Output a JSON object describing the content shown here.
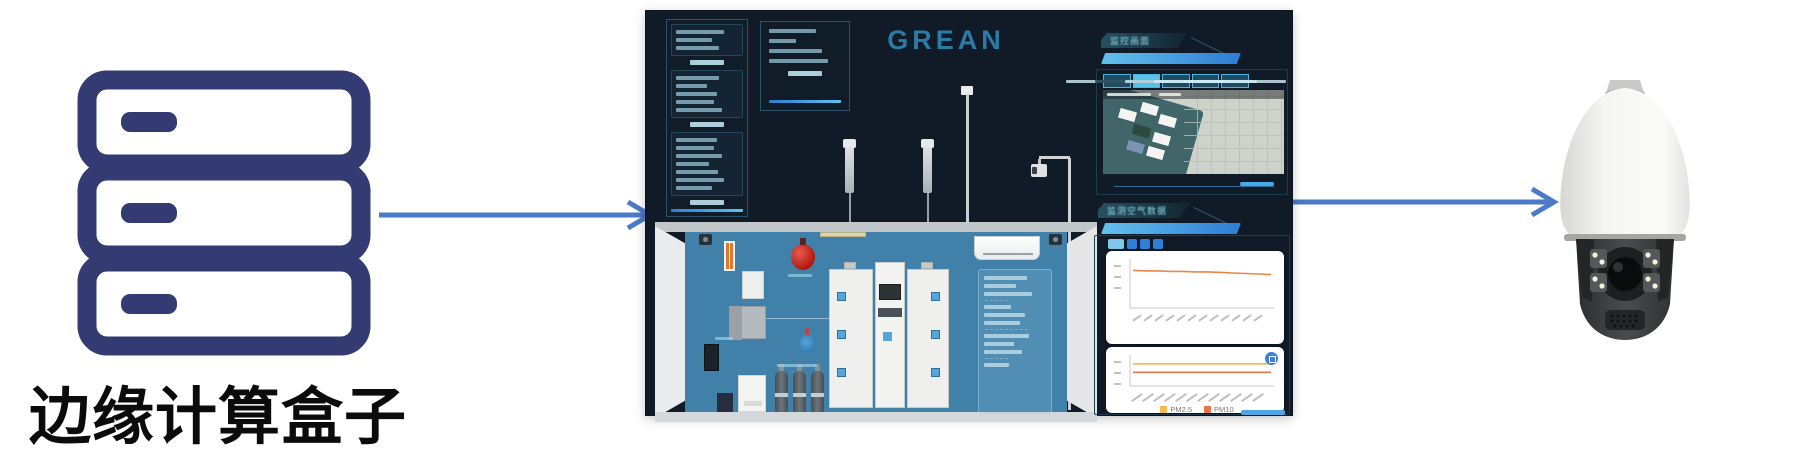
{
  "diagram": {
    "arrow_color": "#4a7ac8",
    "left_node": {
      "label": "边缘计算盒子",
      "icon": "server-stack-icon",
      "icon_color": "#333b72",
      "label_color": "#0b0b0b"
    },
    "center_node": {
      "description": "monitoring-dashboard-screenshot"
    },
    "right_node": {
      "icon": "ptz-dome-camera"
    }
  },
  "dashboard": {
    "logo": "GREAN",
    "logo_color": "#2b7ba6",
    "bg_color": "#111a27",
    "room_wall_color": "#4181a9",
    "left_panel": {
      "sections": [
        {
          "rows": 3
        },
        {
          "rows": 5
        },
        {
          "rows": 7
        }
      ]
    },
    "info_box": {
      "rows": 4
    },
    "video_panel": {
      "title": "监控画面",
      "tabs": [
        "",
        "",
        "",
        "",
        ""
      ],
      "active_tab": 1
    },
    "air_panel": {
      "title": "监测空气数据"
    },
    "room": {
      "overlay_rows": 10,
      "equipment": [
        "fire-suppression-ball",
        "monitoring-cabinet-left",
        "monitoring-cabinet-center",
        "monitoring-cabinet-right",
        "air-conditioner",
        "gas-cylinders",
        "sampling-probes",
        "sampling-pole",
        "ceiling-camera",
        "wall-cameras",
        "data-overlay-panel",
        "ups-cabinet",
        "access-device"
      ]
    }
  },
  "chart_data": [
    {
      "type": "line",
      "title": "",
      "x": [
        "",
        "",
        "",
        "",
        "",
        "",
        "",
        "",
        "",
        "",
        "",
        ""
      ],
      "series": [
        {
          "name": "颗粒物",
          "color": "#e8874a",
          "values": [
            66,
            65,
            65,
            64,
            64,
            63,
            63,
            62,
            61,
            60,
            59,
            58
          ]
        }
      ],
      "ylim": [
        0,
        80
      ],
      "xlabel": "",
      "ylabel": "",
      "grid": false,
      "legend_position": "none"
    },
    {
      "type": "line",
      "title": "",
      "x": [
        "",
        "",
        "",
        "",
        "",
        "",
        "",
        "",
        "",
        "",
        "",
        ""
      ],
      "series": [
        {
          "name": "PM2.5",
          "color": "#f3bc4a",
          "values": [
            72,
            72,
            72,
            72,
            72,
            72,
            72,
            72,
            72,
            72,
            72,
            72
          ]
        },
        {
          "name": "PM10",
          "color": "#e9744a",
          "values": [
            40,
            40,
            40,
            40,
            40,
            40,
            40,
            40,
            40,
            40,
            40,
            40
          ]
        }
      ],
      "ylim": [
        0,
        90
      ],
      "xlabel": "",
      "ylabel": "",
      "grid": false,
      "legend_position": "bottom"
    }
  ]
}
